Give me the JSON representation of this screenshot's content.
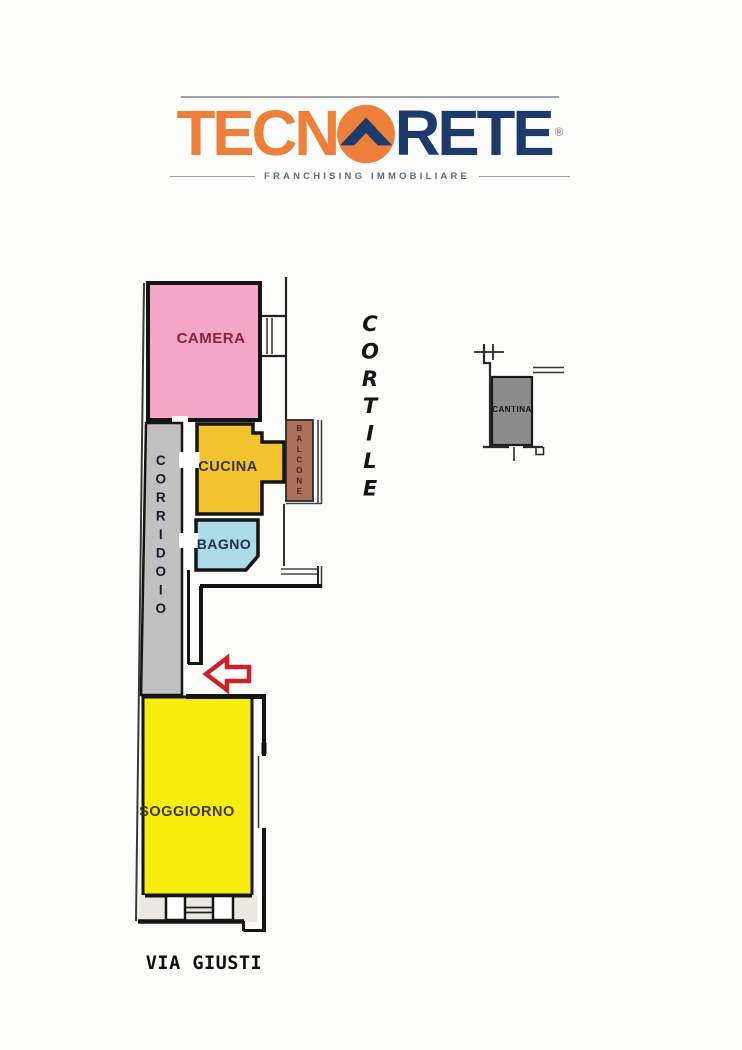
{
  "page": {
    "background": "#fcfcfa"
  },
  "logo": {
    "brand_prefix": "TECN",
    "brand_suffix": "RETE",
    "registered_mark": "®",
    "tagline": "FRANCHISING IMMOBILIARE",
    "colors": {
      "orange": "#ee7f3b",
      "navy": "#1d3a6d",
      "tagline_gray": "#5f6d7d"
    }
  },
  "plan": {
    "rooms": {
      "camera": {
        "label": "CAMERA",
        "fill": "#f3a6c6",
        "label_color": "#8e1f3c"
      },
      "cucina": {
        "label": "CUCINA",
        "fill": "#f3c22f",
        "label_color": "#3a3520"
      },
      "bagno": {
        "label": "BAGNO",
        "fill": "#abdbe6",
        "label_color": "#1c2f55"
      },
      "soggiorno": {
        "label": "SOGGIORNO",
        "fill": "#f8ee0e",
        "label_color": "#3c3a15"
      },
      "corridoio": {
        "label": "CORRIDOIO",
        "fill": "#c0c0c0",
        "label_color": "#16162c"
      },
      "balcone": {
        "label": "BALCONE",
        "fill": "#aa7258",
        "label_color": "#5f1b17"
      },
      "cantina": {
        "label": "CANTINA",
        "fill": "#8c8c8c",
        "label_color": "#111111"
      }
    },
    "outdoor": {
      "cortile_label": "CORTILE",
      "street_label": "VIA GIUSTI"
    },
    "entrance_arrow_color": "#cd2027",
    "wall_color": "#141414"
  }
}
